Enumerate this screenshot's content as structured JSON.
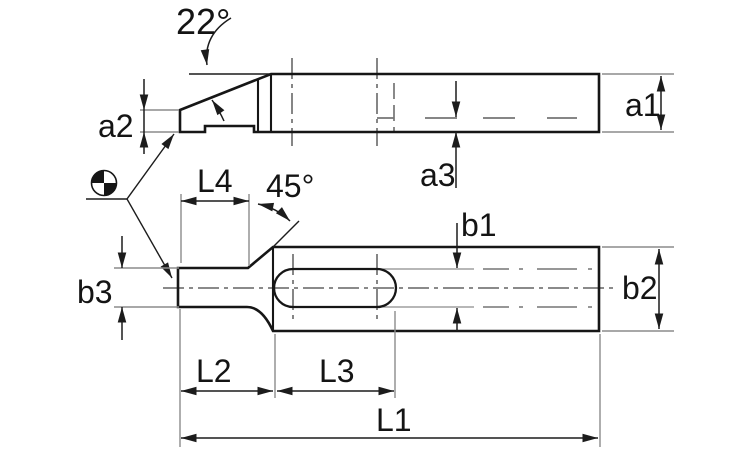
{
  "labels": {
    "angle_22": "22°",
    "angle_45": "45°",
    "a1": "a1",
    "a2": "a2",
    "a3": "a3",
    "b1": "b1",
    "b2": "b2",
    "b3": "b3",
    "L1": "L1",
    "L2": "L2",
    "L3": "L3",
    "L4": "L4"
  },
  "colors": {
    "background": "#ffffff",
    "outline": "#161616",
    "dimension": "#1c1c1c",
    "extension": "#8c8c8c",
    "hidden": "#757575",
    "centerline": "#454545",
    "text": "#141414"
  },
  "symbols": {
    "datum_target": "circle with opposing filled quadrants (mass-center / datum target mark)"
  }
}
